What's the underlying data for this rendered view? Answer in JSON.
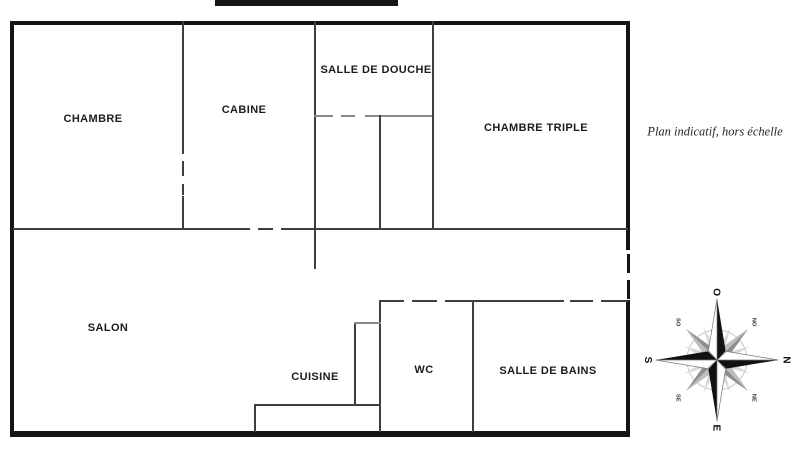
{
  "plan": {
    "note": "Plan indicatif, hors échelle",
    "rooms": {
      "chambre": {
        "label": "CHAMBRE"
      },
      "cabine": {
        "label": "CABINE"
      },
      "salle_de_douche": {
        "label": "SALLE DE DOUCHE"
      },
      "chambre_triple": {
        "label": "CHAMBRE TRIPLE"
      },
      "salon": {
        "label": "SALON"
      },
      "cuisine": {
        "label": "CUISINE"
      },
      "wc": {
        "label": "WC"
      },
      "salle_de_bains": {
        "label": "SALLE DE BAINS"
      }
    },
    "colors": {
      "outer_wall": "#141414",
      "inner_wall": "#3f3f3f",
      "text": "#1c1c1c",
      "compass_black": "#111111",
      "compass_grey": "#9a9a9a"
    },
    "compass": {
      "n": "N",
      "ne": "NE",
      "e": "E",
      "se": "SE",
      "s": "S",
      "so": "SO",
      "o": "O",
      "no": "NO",
      "orientation_note": "north-points-right"
    }
  }
}
